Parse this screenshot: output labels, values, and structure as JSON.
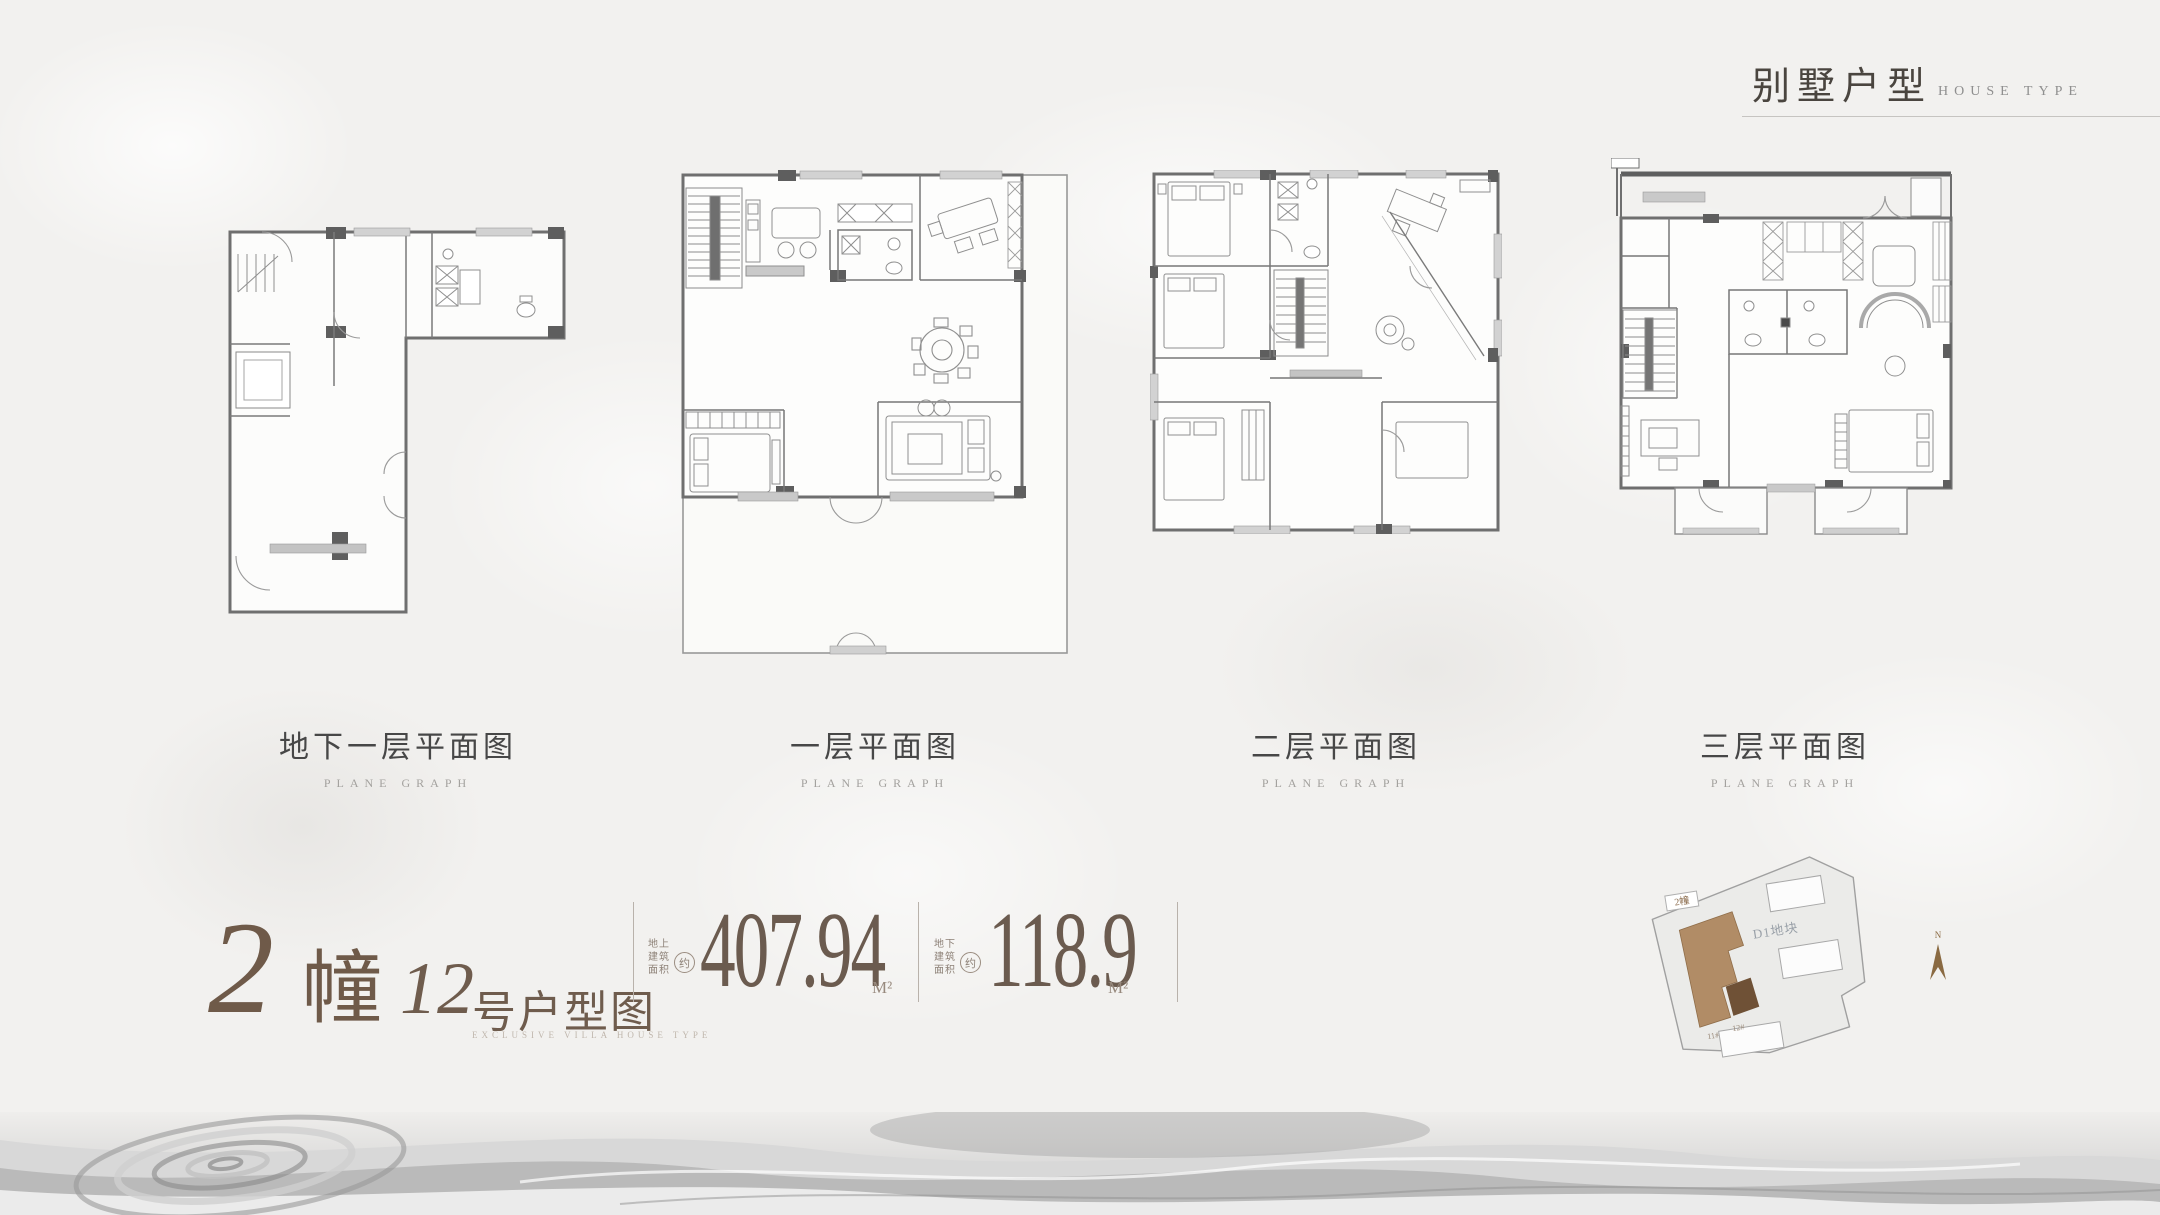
{
  "header": {
    "title_cn": "别墅户型",
    "title_en": "HOUSE TYPE"
  },
  "plans": [
    {
      "caption_cn": "地下一层平面图",
      "caption_en": "PLANE GRAPH"
    },
    {
      "caption_cn": "一层平面图",
      "caption_en": "PLANE GRAPH"
    },
    {
      "caption_cn": "二层平面图",
      "caption_en": "PLANE GRAPH"
    },
    {
      "caption_cn": "三层平面图",
      "caption_en": "PLANE GRAPH"
    }
  ],
  "title_block": {
    "building_no": "2",
    "building_unit": "幢",
    "unit_no": "12",
    "unit_label": "号户型图",
    "unit_sub_en": "EXCLUSIVE VILLA HOUSE TYPE",
    "area1": {
      "label_lines": [
        "地上",
        "建筑",
        "面积"
      ],
      "approx": "约",
      "value": "407.94",
      "unit": "M²"
    },
    "area2": {
      "label_lines": [
        "地下",
        "建筑",
        "面积"
      ],
      "approx": "约",
      "value": "118.9",
      "unit": "M²"
    }
  },
  "site_plan": {
    "building_tag": "2幢",
    "parcel_label": "D1地块",
    "unit_tags": [
      "11#",
      "12#"
    ],
    "north_label": "N"
  },
  "colors": {
    "accent_brown": "#6f5a49",
    "area_text": "#6b5b4f",
    "muted_label": "#8d8177",
    "caption": "#474747",
    "caption_en": "#a3a19e",
    "header_line": "#c6c4c1",
    "plan_wall": "#6f6f6f",
    "site_highlight": "#b18c66",
    "site_highlight_dark": "#6f5136",
    "north_arrow": "#8a6a42"
  }
}
